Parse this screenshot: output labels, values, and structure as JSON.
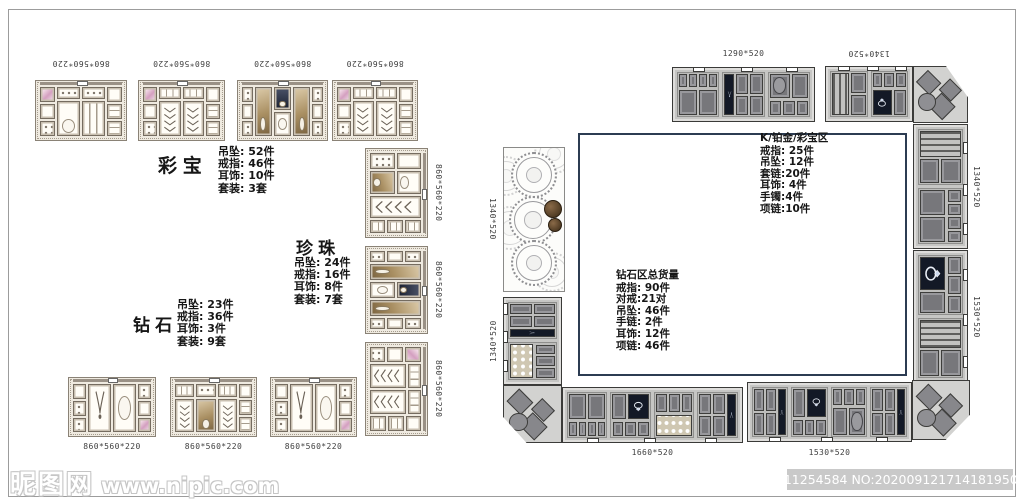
{
  "left_elevations": {
    "areas": [
      {
        "name": "彩宝",
        "lines": [
          "吊坠: 52件",
          "戒指: 46件",
          "耳饰: 10件",
          "套装: 3套"
        ]
      },
      {
        "name": "珍珠",
        "lines": [
          "吊坠: 24件",
          "戒指: 16件",
          "耳饰: 8件",
          "套装: 7套"
        ]
      },
      {
        "name": "钻石",
        "lines": [
          "吊坠: 23件",
          "戒指: 36件",
          "耳饰: 3件",
          "套装: 9套"
        ]
      }
    ],
    "dims_top": [
      "860*560*220",
      "860*560*220",
      "860*560*220",
      "860*560*220"
    ],
    "dims_right": [
      "860*560*220",
      "860*560*220",
      "860*560*220"
    ],
    "dims_bottom": [
      "860*560*220",
      "860*560*220",
      "860*560*220"
    ]
  },
  "floor_plan": {
    "zones": [
      {
        "name": "K/铂金/彩宝区",
        "lines": [
          "戒指: 25件",
          "吊坠: 12件",
          "套链:20件",
          "耳饰: 4件",
          "手镯:4件",
          "项链:10件"
        ]
      },
      {
        "name": "钻石区总货量",
        "lines": [
          "戒指: 90件",
          "对戒:21对",
          "吊坠: 46件",
          "手链: 2件",
          "耳饰: 12件",
          "项链: 46件"
        ]
      }
    ],
    "dims": {
      "top_left": "1290*520",
      "top_right": "1340*520",
      "right_upper": "1340*520",
      "right_lower": "1530*520",
      "bottom_left": "1660*520",
      "bottom_right": "1530*520",
      "left_upper": "1340*520",
      "left_lower": "1340*520"
    }
  },
  "watermark": {
    "site": "昵图网",
    "url": "www.nipic.com",
    "stamp": "ID:11254584 NO:20200912171418195000"
  },
  "colors": {
    "floor_border": "#2c3c52",
    "display_navy": "#131926",
    "plan_cabinet_gray": "#c6c6c4",
    "elevation_cream": "#efeae0",
    "accent_pink": "#d49fc0"
  }
}
